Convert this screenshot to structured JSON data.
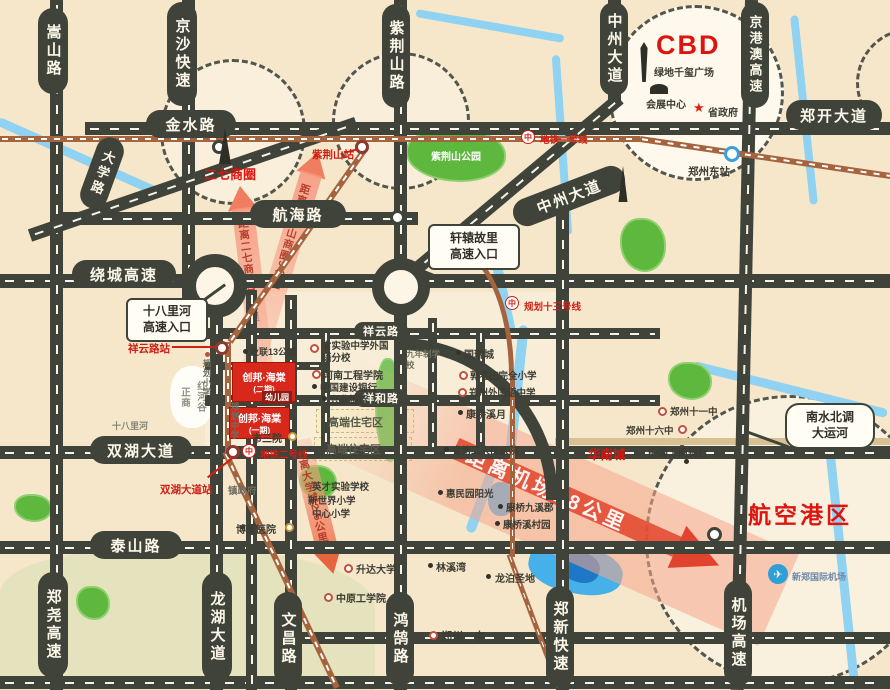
{
  "roads": {
    "songshan": "嵩山路",
    "jingsha": "京沙快速",
    "jinshui": "金水路",
    "daxue": "大学路",
    "zijingshan": "紫荆山路",
    "zhongzhou_n": "中州大道",
    "jinggangao": "京港澳高速",
    "zhengkai": "郑开大道",
    "hanghai": "航海路",
    "zhongzhou": "中州大道",
    "raocheng": "绕城高速",
    "xiangyun": "祥云路",
    "xianghe": "祥和路",
    "shuanghu": "双湖大道",
    "taishan": "泰山路",
    "zhengyao": "郑尧高速",
    "longhu": "龙湖大道",
    "wenchang": "文昌路",
    "honghu": "鸿鹄路",
    "zhengxin": "郑新快速",
    "jichang": "机场高速"
  },
  "districts": {
    "erqi": "二七商圈",
    "cbd": "CBD",
    "hangkonggang": "航空港区"
  },
  "metro": {
    "line1": "地铁一号线",
    "line2": "地铁二号线",
    "line13": "规划十三号线",
    "st_zijingshan": "紫荆山站",
    "st_xiangyunlu": "祥云路站",
    "st_shuanghu": "双湖大道站"
  },
  "project": {
    "phase2": "创邦·海棠",
    "phase2_sub": "(二期)",
    "kindergarten": "幼儿园",
    "phase1": "创邦·海棠",
    "phase1_sub": "(一期)"
  },
  "arrows": {
    "erqi": "距离二七商圈13公里",
    "zijingshan": "距离紫荆山商圈9公里",
    "university": "距离大学城2.5公里",
    "airport": "距离机场18公里"
  },
  "callouts": {
    "shibalihe_l1": "十八里河",
    "shibalihe_l2": "高速入口",
    "xuanyuan_l1": "轩辕故里",
    "xuanyuan_l2": "高速入口",
    "canal_l1": "南水北调",
    "canal_l2": "大运河"
  },
  "landmarks": {
    "greenland": "绿地千玺广场",
    "huizhan": "会展中心",
    "shengzhengfu": "省政府",
    "dongzhan": "郑州东站",
    "airport": "新郑国际机场",
    "huanancheng": "华南城",
    "zijingshan_park": "紫荆山公园"
  },
  "pois": {
    "yelian": "业联13公馆",
    "shiyan": "省实验中学外国语分校",
    "gongcheng": "河南工程学院",
    "jianshe": "中国建设银行",
    "xingye": "兴业银行",
    "guorui": "国瑞城",
    "guolaozhuang": "郭老庄完全小学",
    "waiguoyu": "郑州外国语中学",
    "kq_xiyue": "康桥溪月",
    "sheng2yy": "省第二人民医院",
    "huimin": "惠民园阳光",
    "kq_jiuxijun": "康桥九溪郡",
    "kq_xicunyuan": "康桥溪村园",
    "linxiwan": "林溪湾",
    "longbo": "龙泊圣地",
    "yizhong": "郑州一中",
    "zhenzhengfu": "镇政府",
    "boai": "博爱医院",
    "yingcai": "英才实验学校",
    "xinshijie": "新世界小学",
    "zhongxin": "中心小学",
    "shengda": "升达大学",
    "zhongyuan": "中原工学院",
    "zhengshang_a": "正商",
    "zhengshang_b": "红河谷",
    "shibalihe": "十八里河",
    "guihua_xx": "规划小学",
    "guihua_zx": "规划中学",
    "jiunianzhi": "九年制学校",
    "sanyuan": "市三院",
    "gaoduan1": "高端住宅区",
    "gaoduan2": "高端住宅区",
    "shiliuzhong": "郑州十六中",
    "shiyizhong": "郑州十一中",
    "gongshang": "中国工商银行"
  },
  "icons": {
    "metro_logo": "中",
    "gov_star": "★",
    "airplane": "✈"
  }
}
